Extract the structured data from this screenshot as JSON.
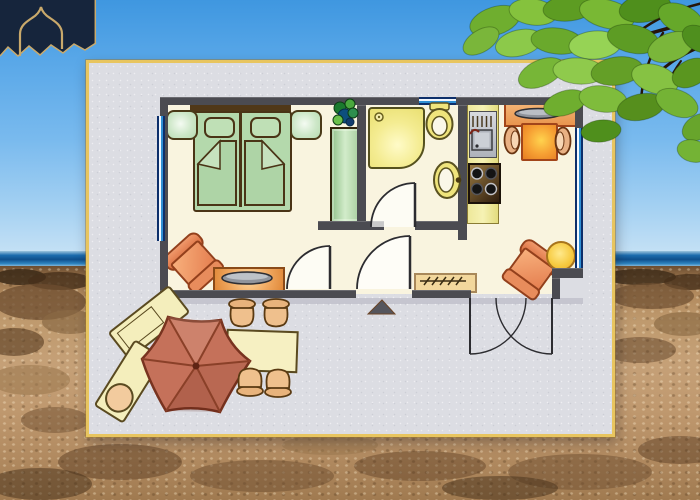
{
  "scene": {
    "kind": "apartment floor plan card over beach photograph",
    "visible_text": [],
    "background": {
      "elements": [
        "sky",
        "sea-horizon-strip",
        "rocky-sand-beach",
        "tree-branch-with-leaves",
        "navy-gold-logo-fragment"
      ],
      "colors": {
        "sky_top": "#3f97e0",
        "sky_bottom": "#cfe6f6",
        "sea": "#0f4f8c",
        "sand": "#bf9a6e",
        "rock_shadow": "#55381e",
        "leaf_green": "#6fae2f",
        "branch_brown": "#26150a",
        "logo_navy": "#16253c",
        "logo_gold": "#c9a96b"
      }
    },
    "card": {
      "border_color": "#e8c55f",
      "paper_color": "#dcdde3",
      "floorplan": {
        "wall_color": "#4b4b51",
        "floor_color": "#f9f4df",
        "window_color": "#2f8fd4",
        "rooms": [
          "bedroom-living-room",
          "bathroom",
          "kitchen-dining",
          "hallway",
          "terrace"
        ],
        "furniture": [
          "twin-beds-with-headboard",
          "pillow-left",
          "pillow-right",
          "nightstand-left",
          "nightstand-right",
          "wardrobe",
          "potted-plant",
          "shower-tray",
          "toilet",
          "washbasin",
          "kitchen-counter",
          "kitchen-sink",
          "stove-4-burners",
          "sideboard-with-tray",
          "dining-table",
          "dining-chair-left",
          "dining-chair-right",
          "armchair-living",
          "tv-lowboard",
          "armchair-corner",
          "round-side-table",
          "doormat",
          "entrance-door-swing",
          "living-room-door-swing",
          "bathroom-door-swing",
          "french-doors-to-terrace",
          "window-left",
          "window-top",
          "window-right"
        ],
        "terrace_items": [
          "parasol-hexagonal",
          "sun-lounger-upper",
          "sun-lounger-lower-with-pillow",
          "outdoor-table",
          "outdoor-chair-1",
          "outdoor-chair-2",
          "outdoor-chair-3",
          "outdoor-chair-4",
          "small-dark-triangle-marker"
        ],
        "furniture_colors": {
          "bed_green": "#b4d9ac",
          "wardrobe_green": "#a3cb9a",
          "fixture_yellow": "#f4ec92",
          "counter_yellow": "#eee89a",
          "orange_furniture": "#e2784a",
          "table_orange": "#f69f33",
          "tan_wood": "#f2d79c",
          "chair_tan": "#efc08d",
          "parasol_terracotta": "#c5715a",
          "lounger_cream": "#f4eebc"
        },
        "counts": {
          "beds": 2,
          "nightstands": 2,
          "dining_chairs": 2,
          "armchairs": 2,
          "outdoor_chairs": 4,
          "sun_loungers": 2,
          "stove_burners": 4
        }
      }
    }
  }
}
